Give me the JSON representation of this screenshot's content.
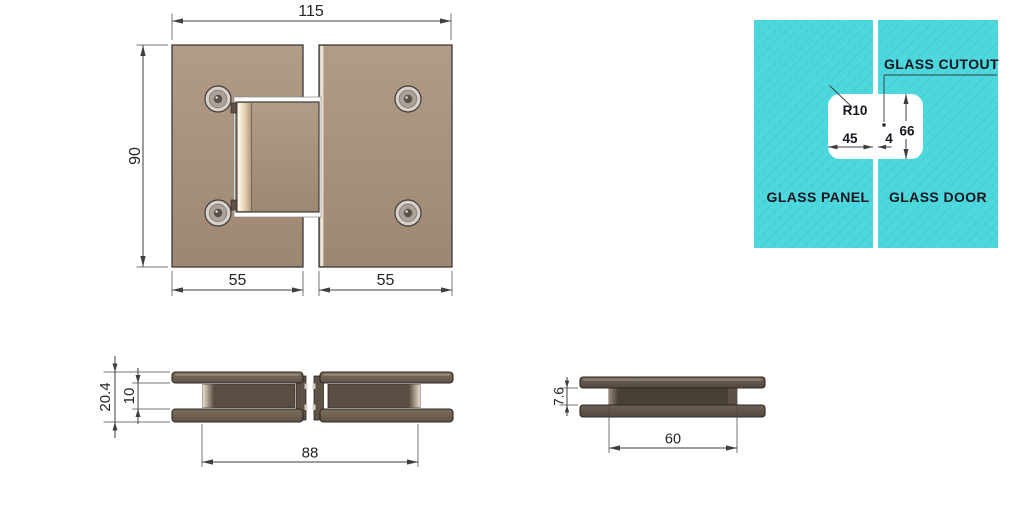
{
  "front_view": {
    "width_label": "115",
    "height_label": "90",
    "left_plate_width_label": "55",
    "right_plate_width_label": "55"
  },
  "glass_diagram": {
    "cutout_label": "GLASS CUTOUT",
    "panel_label": "GLASS PANEL",
    "door_label": "GLASS DOOR",
    "corner_radius_label": "R10",
    "cutout_height_label": "66",
    "cutout_half_width_label": "45",
    "gap_label": "4"
  },
  "side_view_pair": {
    "total_thickness_label": "20.4",
    "glass_gap_label": "10",
    "body_span_label": "88"
  },
  "side_view_single": {
    "glass_gap_label": "7.6",
    "body_width_label": "60"
  },
  "colors": {
    "glass": "#4dd8dd",
    "hinge_bronze": "#a8917e",
    "hinge_brown": "#6a5b4d",
    "hinge_dark_brown": "#5e5247",
    "line": "#3e3e3e",
    "label_text": "#15151f"
  }
}
